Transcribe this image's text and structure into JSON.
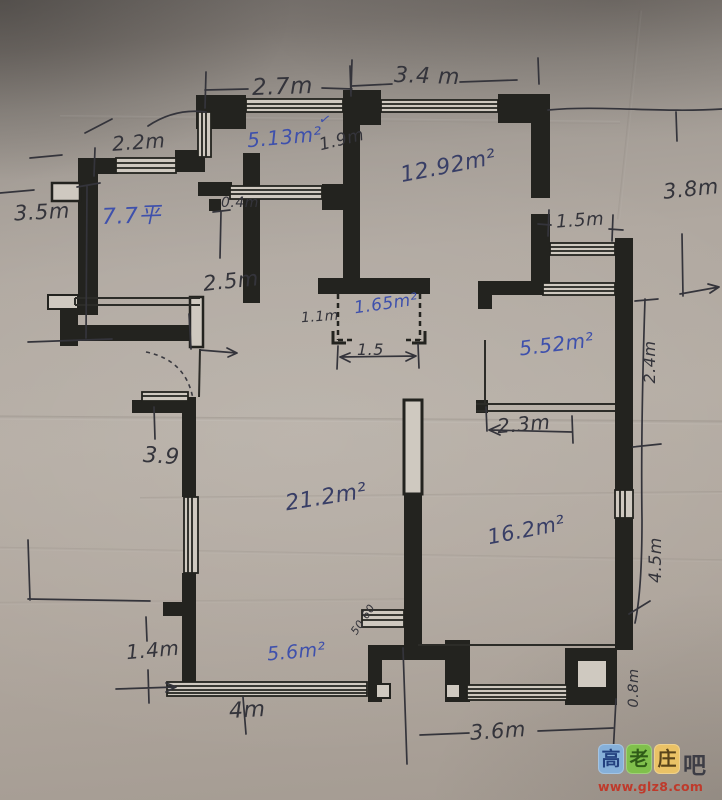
{
  "colors": {
    "wall": "#23231f",
    "print": "#2c2c28",
    "pen": "#34343b",
    "ink_blue": "#3e50ac",
    "ink_dark": "#383e66"
  },
  "labels": {
    "dim_2_7": "2.7m",
    "dim_3_4": "3.4 m",
    "dim_2_2": "2.2m",
    "dim_1_9": "1.9m",
    "dim_3_8": "3.8m",
    "dim_3_5": "3.5m",
    "dim_0_4": "0.4m",
    "dim_2_5": "2.5m",
    "dim_1_5_window": "1.5m",
    "dim_1_1": "1.1m",
    "dim_1_5_arrow": "1.5",
    "dim_2_4": "2.4m",
    "dim_2_3": "2.3m",
    "dim_3_9": "3.9",
    "dim_4_5": "4.5m",
    "dim_1_4": "1.4m",
    "dim_4": "4m",
    "dim_3_6": "3.6m",
    "dim_0_8": "0.8m",
    "area_7_7": "7.7平",
    "area_5_13": "5.13m²",
    "check_5_13": "✓",
    "area_12_92": "12.92m²",
    "area_1_65": "1.65m²",
    "area_5_52": "5.52m²",
    "area_21_2": "21.2m²",
    "area_16_2": "16.2m²",
    "area_5_6": "5.6m²",
    "scribble": "50 60"
  },
  "watermark": {
    "tiles": [
      {
        "char": "高",
        "bg": "#86b0d9",
        "fg": "#23417f"
      },
      {
        "char": "老",
        "bg": "#80c04c",
        "fg": "#2f5c18"
      },
      {
        "char": "庄",
        "bg": "#eac266",
        "fg": "#59431a"
      }
    ],
    "suffix": "吧",
    "suffix_color": "#3d3d45",
    "url": "www.glz8.com",
    "url_color": "#bf3a2b"
  }
}
